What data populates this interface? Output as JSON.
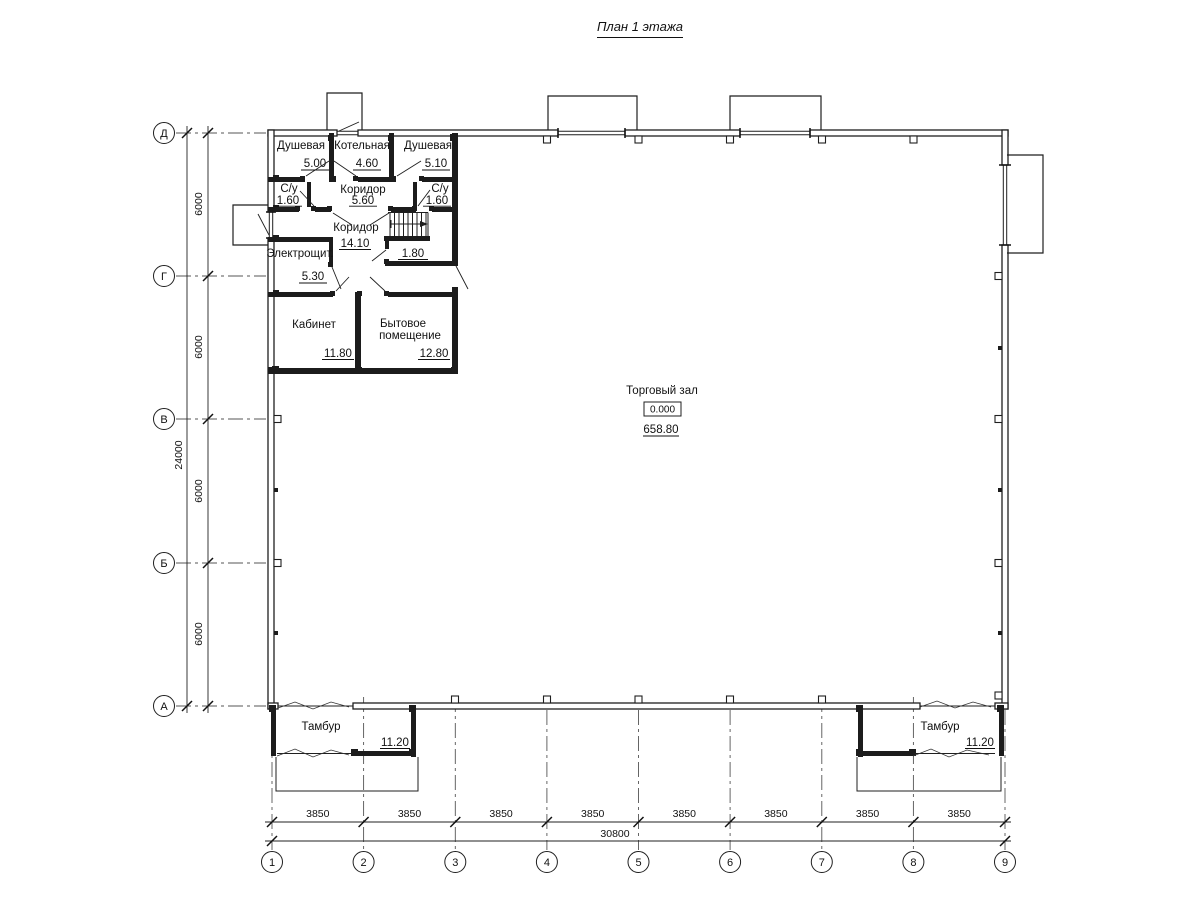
{
  "title": "План 1 этажа",
  "axes": {
    "rows": [
      "Д",
      "Г",
      "В",
      "Б",
      "А"
    ],
    "cols": [
      "1",
      "2",
      "3",
      "4",
      "5",
      "6",
      "7",
      "8",
      "9"
    ]
  },
  "dims": {
    "left": {
      "segments": [
        "6000",
        "6000",
        "6000",
        "6000"
      ],
      "total": "24000"
    },
    "bottom": {
      "segments": [
        "3850",
        "3850",
        "3850",
        "3850",
        "3850",
        "3850",
        "3850",
        "3850"
      ],
      "total": "30800"
    }
  },
  "rooms": [
    {
      "name": "Душевая",
      "area": "5.00"
    },
    {
      "name": "Котельная",
      "area": "4.60"
    },
    {
      "name": "Душевая",
      "area": "5.10"
    },
    {
      "name": "С/у",
      "area": "1.60"
    },
    {
      "name": "Коридор",
      "area": "5.60"
    },
    {
      "name": "С/у",
      "area": "1.60"
    },
    {
      "name": "Коридор",
      "area": "14.10"
    },
    {
      "name": "Электрощит.",
      "area": "5.30"
    },
    {
      "name": "Кабинет",
      "area": "11.80"
    },
    {
      "name": "Бытовое",
      "name2": "помещение",
      "area": "12.80"
    },
    {
      "area": "1.80"
    },
    {
      "name": "Торговый зал",
      "level": "0.000",
      "area": "658.80"
    },
    {
      "name": "Тамбур",
      "area": "11.20"
    },
    {
      "name": "Тамбур",
      "area": "11.20"
    }
  ]
}
